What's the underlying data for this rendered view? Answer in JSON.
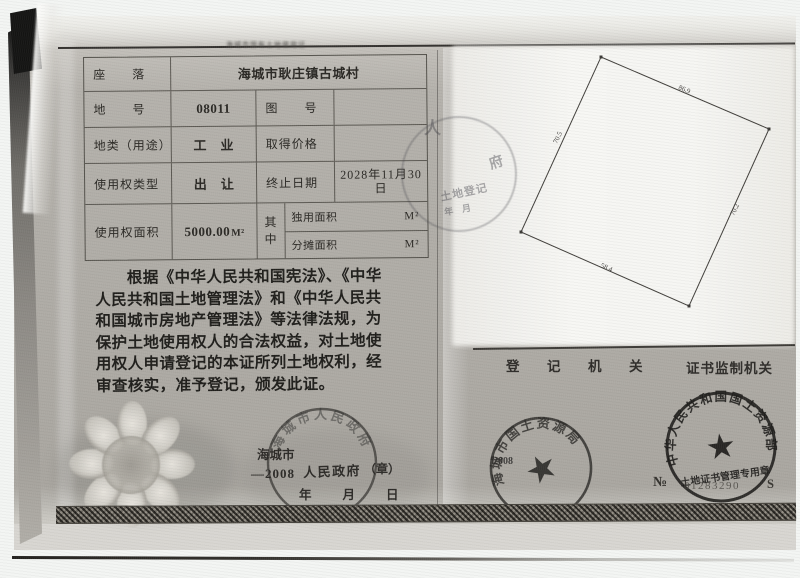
{
  "scan": {
    "microprint": "海城市国有土地使用证"
  },
  "table": {
    "r1_label": "座　　落",
    "r1_value": "海城市耿庄镇古城村",
    "r2_label": "地　　号",
    "r2_value": "08011",
    "r2_label2": "图　　号",
    "r2_value2": "",
    "r3_label": "地类（用途）",
    "r3_value": "工　业",
    "r3_label2": "取得价格",
    "r3_value2": "",
    "r4_label": "使用权类型",
    "r4_value": "出　让",
    "r4_label2": "终止日期",
    "r4_value2_line1": "2028年11月30",
    "r4_value2_line2": "日",
    "r5_label": "使用权面积",
    "r5_value": "5000.00",
    "r5_unit": "M²",
    "r5_mid_top": "其",
    "r5_mid_bottom": "中",
    "r5_sub1_label": "独用面积",
    "r5_sub1_unit": "M²",
    "r5_sub2_label": "分摊面积",
    "r5_sub2_unit": "M²"
  },
  "paragraph": {
    "lines": [
      "　　根据《中华人民共和国宪法》、《中华",
      "人民共和国土地管理法》和《中华人民共",
      "和国城市房地产管理法》等法律法规，为",
      "保护土地使用权人的合法权益，对土地使",
      "用权人申请登记的本证所列土地权利，经",
      "审查核实，准予登记，颁发此证。"
    ]
  },
  "issuer": {
    "city": "海城市",
    "dash_year": "—2008",
    "gov": "人民政府",
    "seal_note": "（章）",
    "date_blanks": "年　　月　　日",
    "seal_arc": "海城市人民政府"
  },
  "right_page": {
    "plot": {
      "edge_top": "86.9",
      "edge_right": "70.2",
      "edge_bottom": "58.4",
      "edge_left": "70.5"
    },
    "registry_label": "登　记　机　关",
    "supervisor_label": "证书监制机关",
    "bureau_seal": {
      "arc": "海城市国土资源局",
      "year": "2008",
      "star": "★"
    },
    "ministry_seal": {
      "arc": "中华人民共和国国土资源部",
      "bottom": "土地证书管理专用章",
      "star": "★"
    },
    "serial": {
      "no": "№",
      "number": "01283290",
      "suffix": "S"
    }
  },
  "faint_stamp": {
    "char1": "人",
    "char2": "府",
    "text": "土地登记",
    "date": "年　月"
  }
}
